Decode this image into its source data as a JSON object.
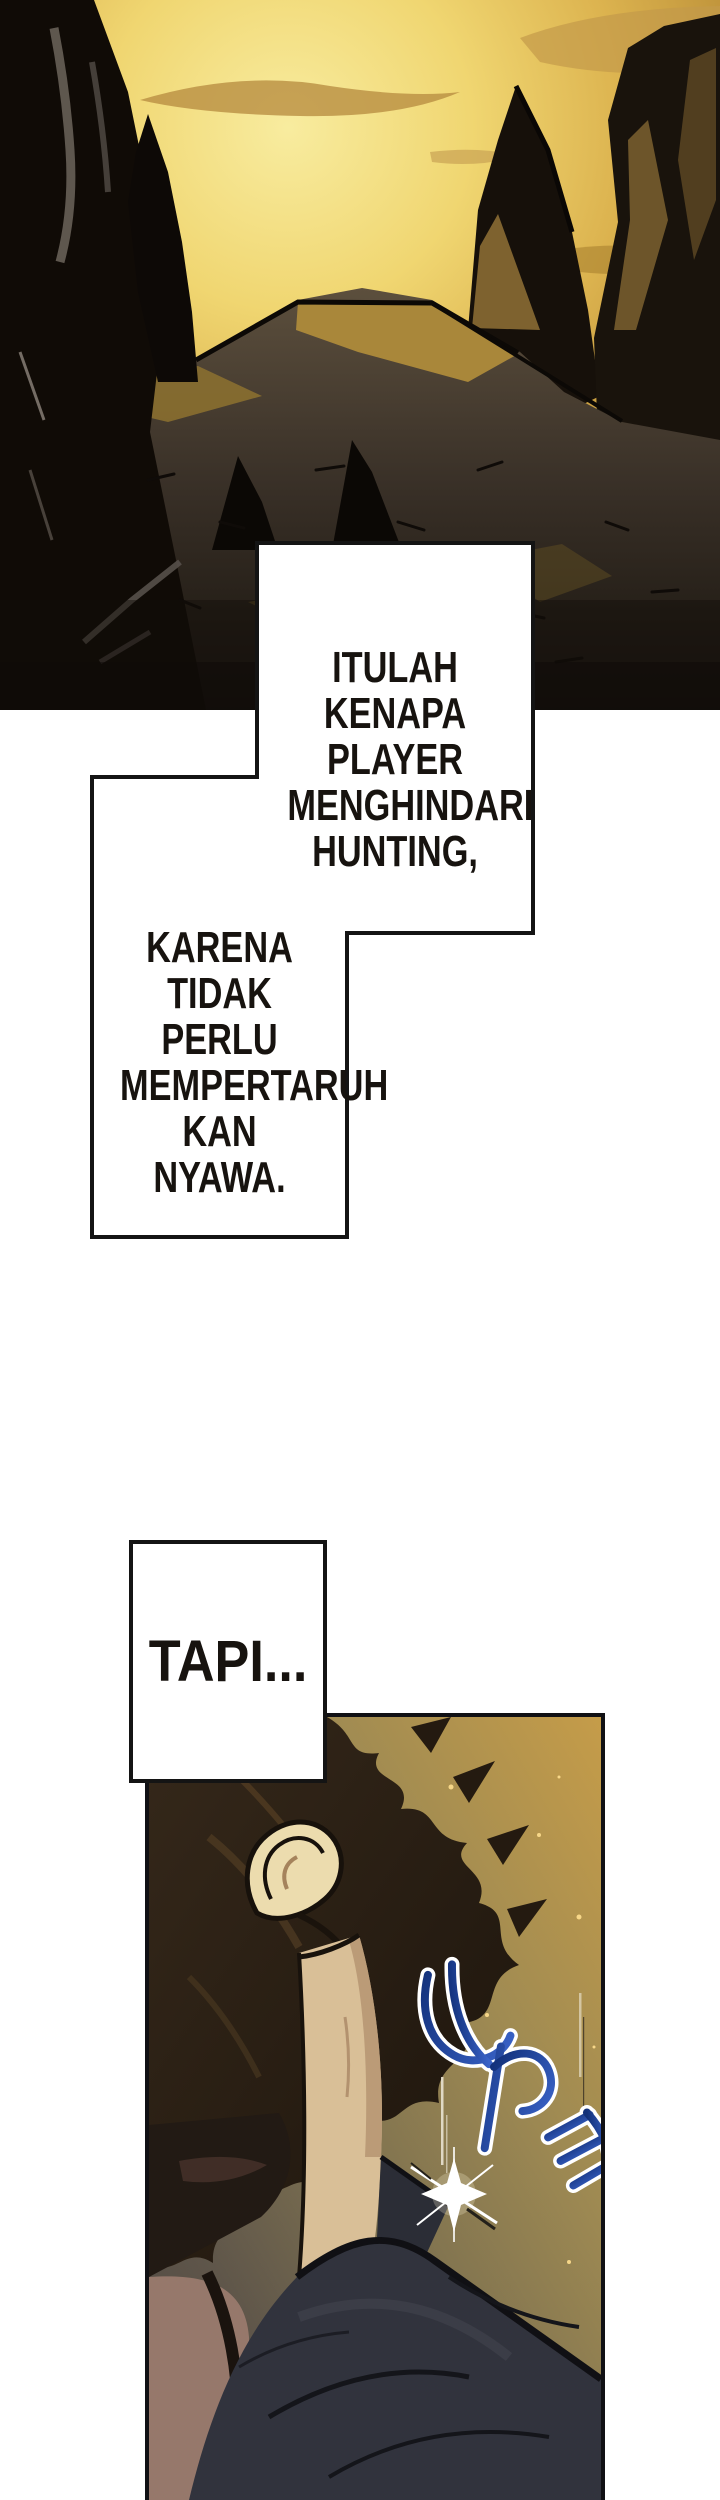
{
  "page": {
    "width": 720,
    "height": 2500,
    "background": "#ffffff"
  },
  "top_panel": {
    "description": "Golden dusk sky over a jagged dark mountain valley with cracked ground",
    "sky_color": "#eecf66",
    "rock_color": "#14100a",
    "ground_color": "#3a3128"
  },
  "bubbles": {
    "bubble1": {
      "lines": [
        "ITULAH",
        "KENAPA PLAYER",
        "MENGHINDARI",
        "HUNTING,"
      ]
    },
    "bubble2": {
      "lines": [
        "KARENA",
        "TIDAK PERLU",
        "MEMPERTARUH",
        "KAN NYAWA."
      ]
    },
    "caption": {
      "label": "TAPI..."
    }
  },
  "bottom_panel": {
    "description": "Close-up of a dark-haired character seen from the side, golden particle dust, blue impact sound-effect lettering and a white flash spark",
    "background_color": "#a08b52",
    "hair_color": "#241a10",
    "skin_color": "#d9bf97",
    "clothing_color": "#31333d",
    "sfx": {
      "type": "sound-effect lettering",
      "color": "#2b50b0",
      "outline_color": "#ffffff"
    }
  }
}
